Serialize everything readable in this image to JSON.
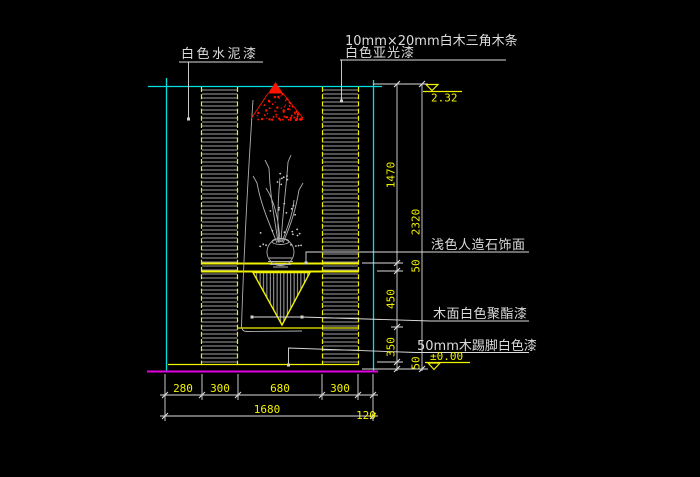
{
  "colors": {
    "background": "#000000",
    "cyan": "#00e0e0",
    "yellow": "#f2f200",
    "white": "#dcdcdc",
    "gray": "#b0b0b0",
    "red": "#ff1400",
    "magenta": "#e000e0"
  },
  "labels": {
    "cement_paint": "白色水泥漆",
    "wood_strip": "10mm×20mm白木三角木条",
    "matte_paint": "白色亚光漆",
    "stone_finish": "浅色人造石饰面",
    "polyester_paint": "木面白色聚酯漆",
    "skirting": "50mm木踢脚白色漆"
  },
  "elevations": {
    "top": "2.32",
    "bottom": "±0.00"
  },
  "dimensions": {
    "right_inner": [
      "1470",
      "450",
      "350"
    ],
    "right_outer": [
      "2320",
      "50",
      "50"
    ],
    "bottom_segments": [
      "280",
      "300",
      "680",
      "300"
    ],
    "bottom_total": "1680",
    "bottom_right_offset": "120"
  }
}
